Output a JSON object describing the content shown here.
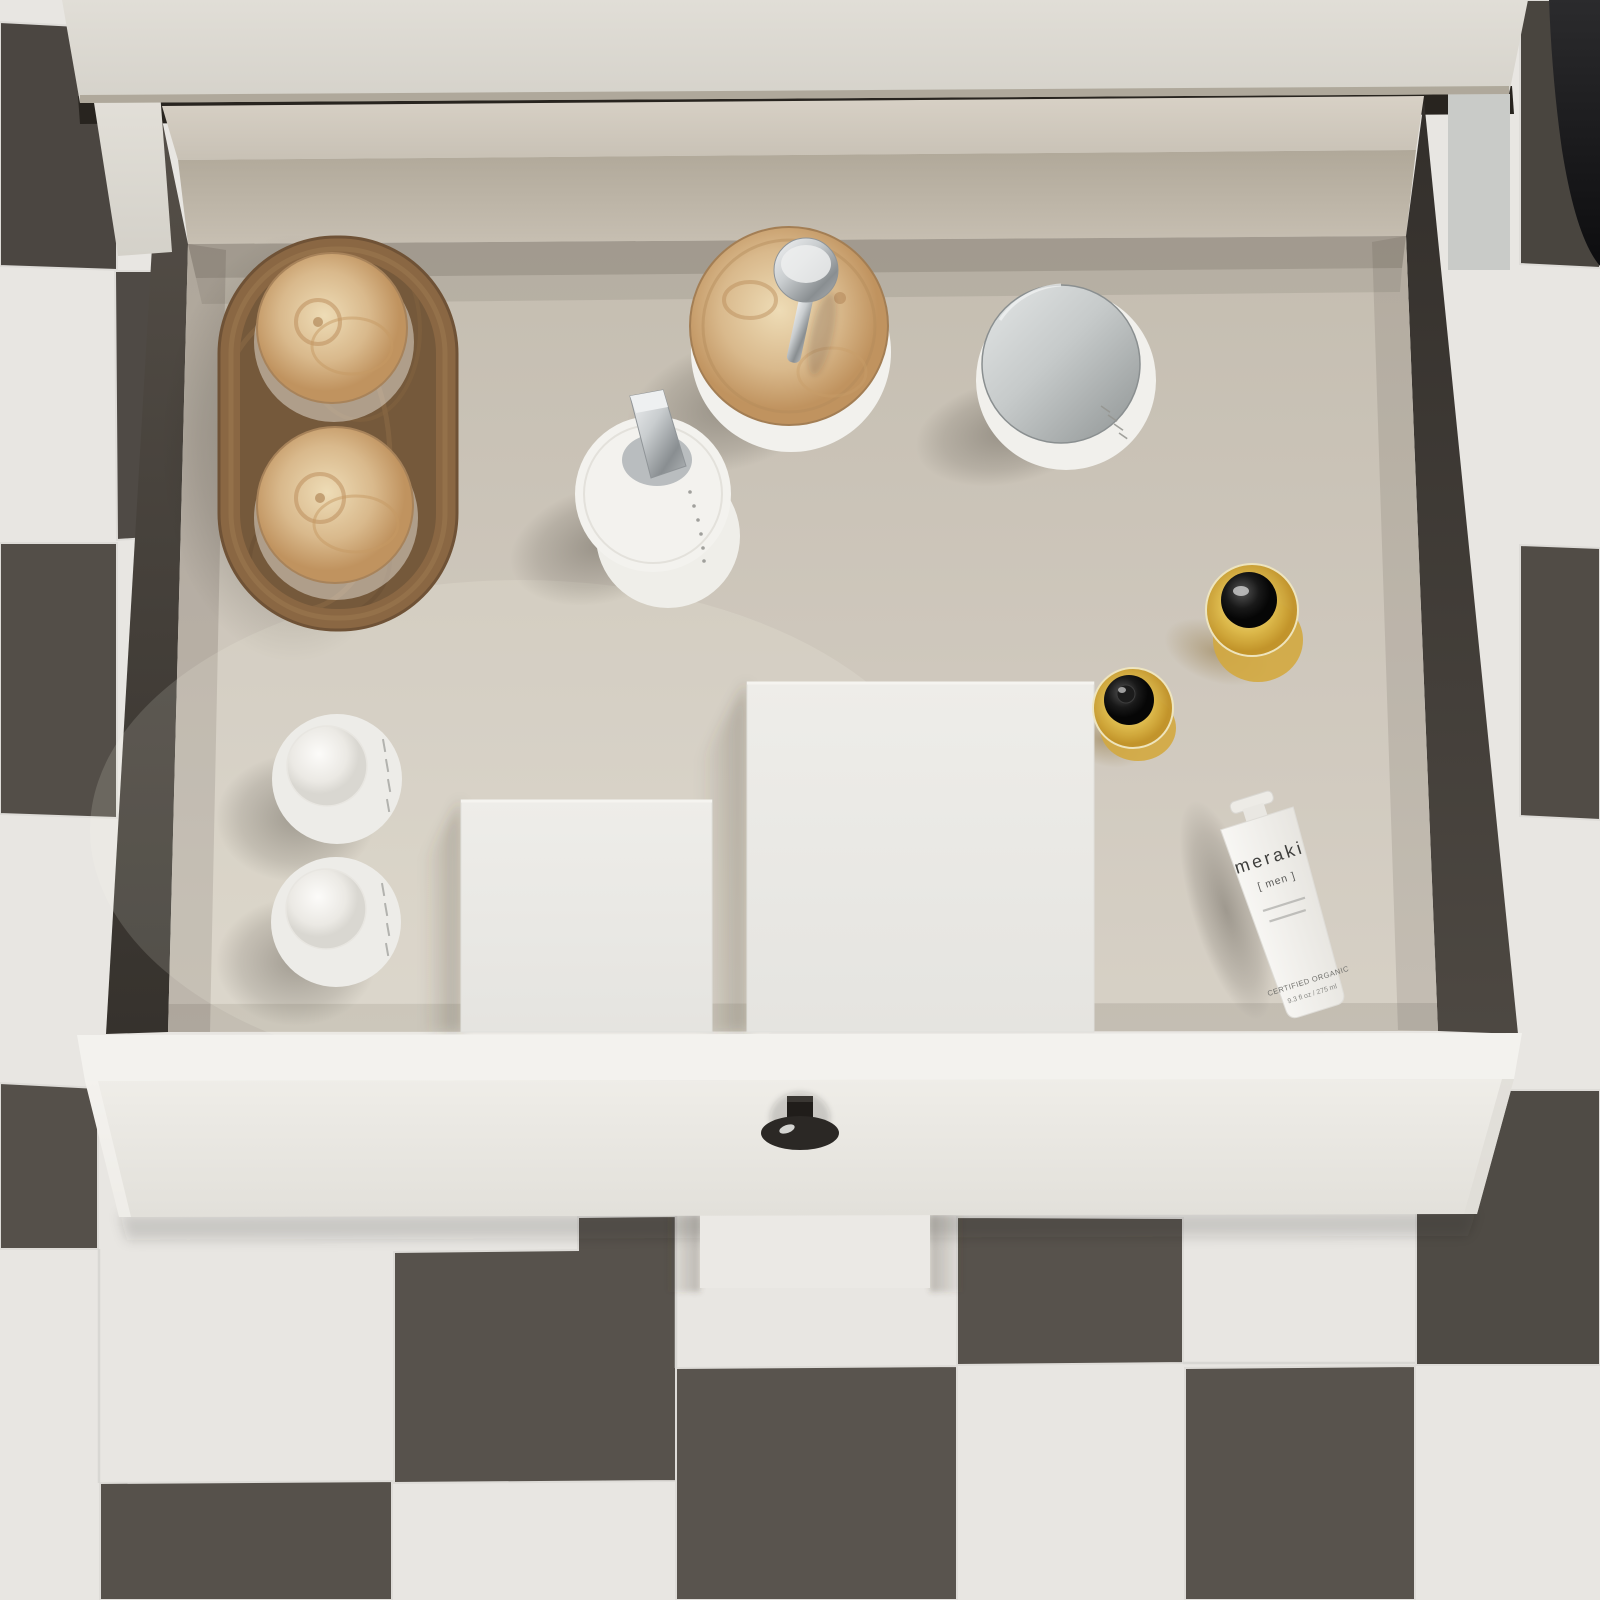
{
  "scene": {
    "type": "3d-render",
    "description": "Top-down view of an open white bathroom vanity drawer organized with skincare and grooming products, standing on a dark and white checkered tile floor",
    "palette": {
      "countertop": "#dcd9d1",
      "drawer_front": "#edebe6",
      "drawer_interior": "#cfc8bd",
      "drawer_wall": "#4a453f",
      "tile_light": "#e8e6e2",
      "tile_dark": "#55504a",
      "burl_wood": "#c9a06c",
      "chrome": "#b9bdbf",
      "amber_glass": "#d4a832",
      "knob": "#24211e"
    },
    "objects": [
      {
        "id": "wooden-tray",
        "label": "Burl wood oval tray holding two wood-lid glass jars"
      },
      {
        "id": "soap-dispenser",
        "label": "White soap dispenser with burl wood lid and chrome pump"
      },
      {
        "id": "lotion-pump-bottle",
        "label": "White pump bottle with chrome dispenser head"
      },
      {
        "id": "cream-jar",
        "label": "White cream jar with chrome lid"
      },
      {
        "id": "organizer-box-small",
        "label": "Small white organizer box"
      },
      {
        "id": "organizer-box-large",
        "label": "Large white organizer box"
      },
      {
        "id": "dome-bottle-1",
        "label": "White cylindrical bottle with dome cap"
      },
      {
        "id": "dome-bottle-2",
        "label": "White cylindrical bottle with dome cap"
      },
      {
        "id": "amber-bottle-large",
        "label": "Amber glass bottle with black cap"
      },
      {
        "id": "amber-bottle-small",
        "label": "Amber glass dropper bottle with black cap"
      },
      {
        "id": "meraki-tube",
        "label": "Meraki men grooming cream tube"
      },
      {
        "id": "drawer-knob",
        "label": "Black drawer knob"
      }
    ],
    "meraki_tube": {
      "brand": "meraki",
      "range": "[ men ]",
      "certification": "CERTIFIED ORGANIC",
      "volume": "9.3 fl oz / 275 ml"
    }
  }
}
